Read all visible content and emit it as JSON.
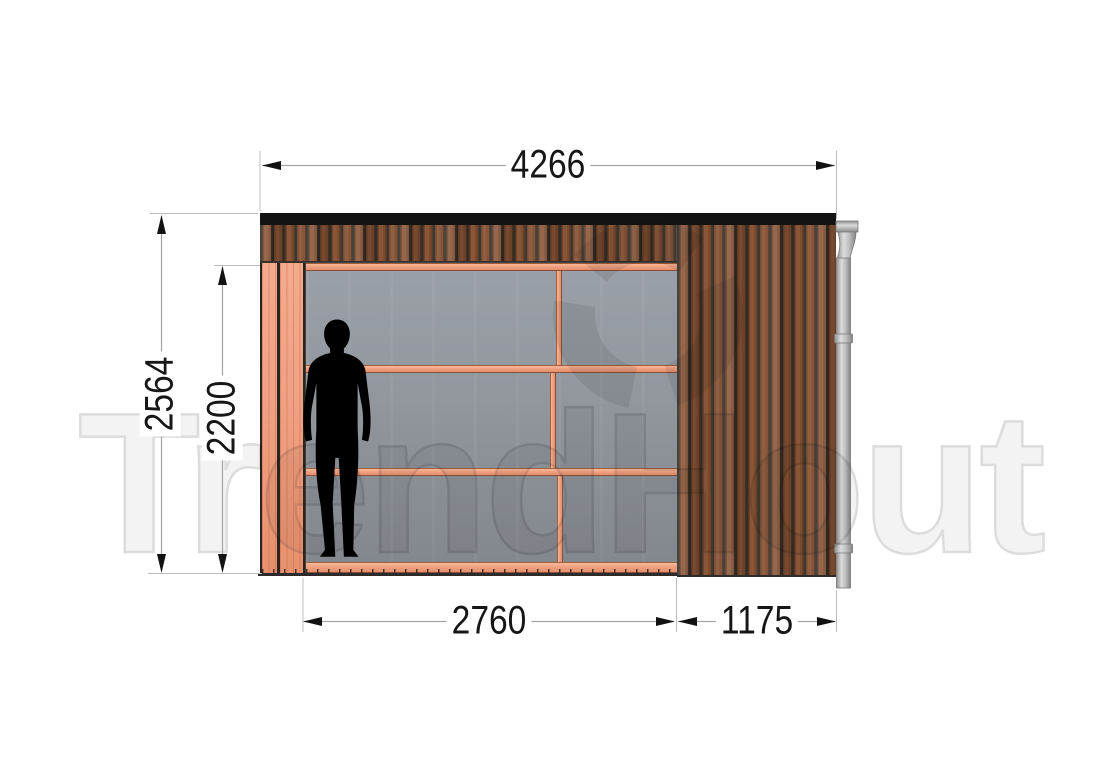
{
  "watermark": {
    "text": "TrendHout"
  },
  "dimensions": {
    "overall_width": "4266",
    "overall_height": "2564",
    "opening_height": "2200",
    "glass_section_width": "2760",
    "side_section_width": "1175"
  },
  "drawing": {
    "view": "front-elevation",
    "elements": [
      "roof-fascia",
      "vertical-wood-cladding",
      "glass-sliding-wall",
      "left-frame-posts",
      "human-scale-figure",
      "rain-downpipe"
    ],
    "glass_wall": {
      "rows": 3,
      "columns": 2,
      "frame_material": "douglas-wood"
    }
  },
  "colors": {
    "cladding_wood": "#8a5637",
    "frame_wood": "#efa183",
    "glass": "#93989f",
    "fascia": "#131313",
    "downpipe": "#c6c6c6",
    "dimension_text": "#161616",
    "dimension_line": "#a3a3a3",
    "watermark": "#dcdcdc"
  }
}
